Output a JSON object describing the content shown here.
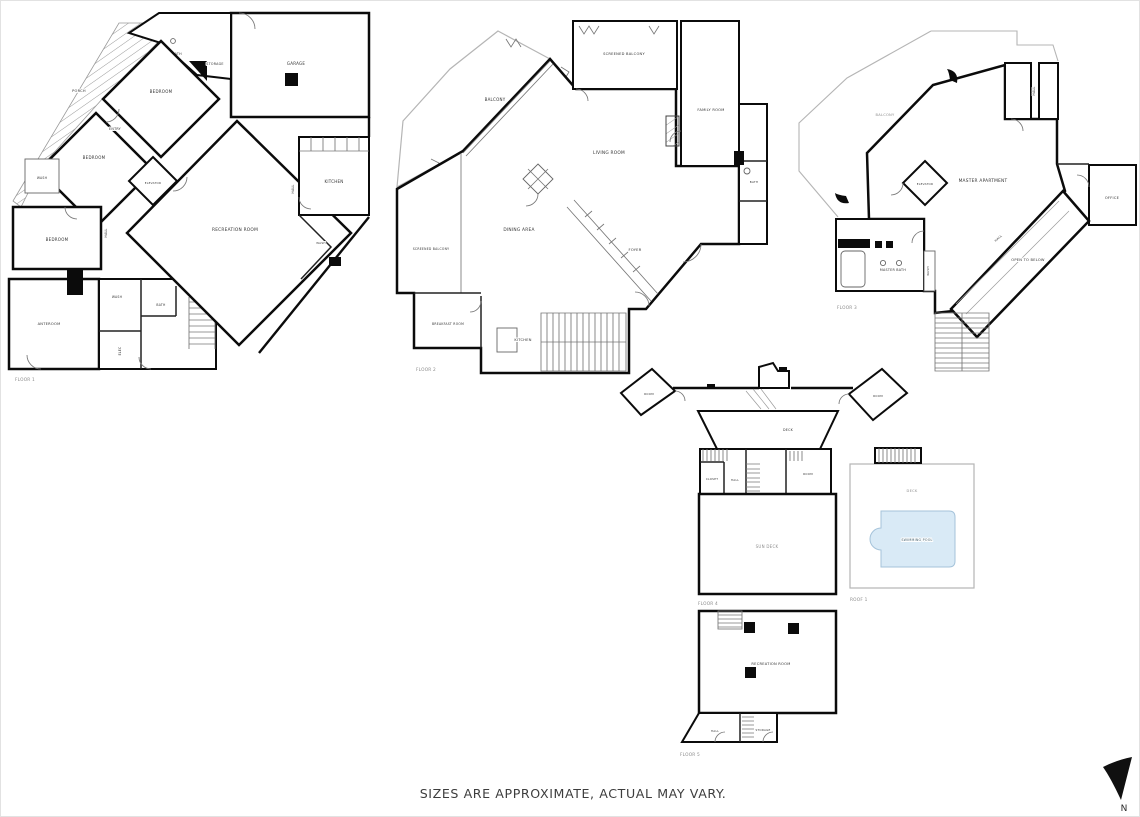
{
  "sheet": {
    "disclaimer": "SIZES ARE APPROXIMATE, ACTUAL MAY VARY.",
    "compass": {
      "label": "N"
    }
  },
  "floor1": {
    "caption": "FLOOR 1",
    "rooms": {
      "porch": "PORCH",
      "bath_top": "BATH",
      "storage": "STORAGE",
      "garage": "GARAGE",
      "bedroom_top": "BEDROOM",
      "entry": "ENTRY",
      "bedroom_mid": "BEDROOM",
      "wash_upper": "WASH",
      "elevator": "ELEVATOR",
      "bedroom_lower": "BEDROOM",
      "hall_left": "HALL",
      "hall_right": "HALL",
      "recreation_room": "RECREATION ROOM",
      "kitchen": "KITCHEN",
      "wash_mid": "WASH",
      "bath_mid": "BATH",
      "wash_right": "WASH",
      "anteroom": "ANTEROOM",
      "elec": "ELEC"
    }
  },
  "floor2": {
    "caption": "FLOOR 2",
    "rooms": {
      "balcony": "BALCONY",
      "screened_balcony_top": "SCREENED BALCONY",
      "family_room": "FAMILY ROOM",
      "living_room": "LIVING ROOM",
      "dining_area": "DINING AREA",
      "screened_balcony_left": "SCREENED BALCONY",
      "foyer": "FOYER",
      "breakfast_room": "BREAKFAST ROOM",
      "kitchen": "KITCHEN",
      "bath": "BATH"
    }
  },
  "floor3": {
    "caption": "FLOOR 3",
    "rooms": {
      "balcony": "BALCONY",
      "hall_top": "HALL",
      "elevator": "ELEVATOR",
      "master_apartment": "MASTER APARTMENT",
      "office": "OFFICE",
      "master_bath": "MASTER BATH",
      "wash": "WASH",
      "hall_diag": "HALL",
      "open_to_below": "OPEN TO BELOW"
    }
  },
  "floor4": {
    "caption": "FLOOR 4",
    "rooms": {
      "room_left": "ROOM",
      "room_right": "ROOM",
      "deck_hall": "DECK",
      "closet": "CLOSET",
      "hall": "HALL",
      "room_small": "ROOM",
      "sun_deck": "SUN DECK"
    }
  },
  "roof": {
    "caption": "ROOF 1",
    "rooms": {
      "deck": "DECK",
      "swimming_pool": "SWIMMING POOL"
    }
  },
  "floor5": {
    "caption": "FLOOR 5",
    "rooms": {
      "recreation_room": "RECREATION ROOM",
      "hall": "HALL",
      "storage": "STORAGE"
    }
  },
  "colors": {
    "wall": "#0b0b0b",
    "pool_fill": "#d9eaf6",
    "pool_edge": "#a5c3da",
    "label": "#333333",
    "caption": "#8a8a8a"
  }
}
